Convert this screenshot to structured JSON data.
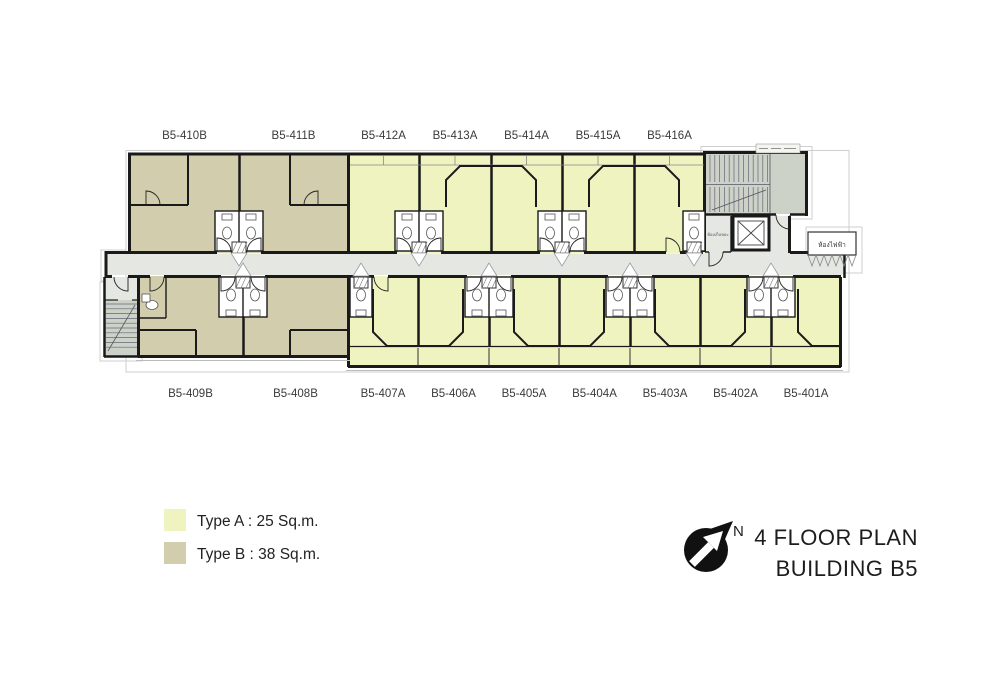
{
  "title": {
    "line1": "4 FLOOR PLAN",
    "line2": "BUILDING B5"
  },
  "north_label": "N",
  "legend": {
    "items": [
      {
        "name": "Type A",
        "text": "Type A :  25 Sq.m.",
        "color": "#eef3c0"
      },
      {
        "name": "Type B",
        "text": "Type B :  38 Sq.m.",
        "color": "#d1cdad"
      }
    ]
  },
  "colors": {
    "type_a": "#eef3c0",
    "type_b": "#d1cdad",
    "corridor": "#e4e7e2",
    "stair": "#ccd2c7",
    "wall": "#1a1a1a",
    "label_text": "#3a3a3a"
  },
  "units": {
    "top": [
      {
        "label": "B5-410B",
        "type": "B"
      },
      {
        "label": "B5-411B",
        "type": "B"
      },
      {
        "label": "B5-412A",
        "type": "A"
      },
      {
        "label": "B5-413A",
        "type": "A"
      },
      {
        "label": "B5-414A",
        "type": "A"
      },
      {
        "label": "B5-415A",
        "type": "A"
      },
      {
        "label": "B5-416A",
        "type": "A"
      }
    ],
    "bottom": [
      {
        "label": "B5-409B",
        "type": "B"
      },
      {
        "label": "B5-408B",
        "type": "B"
      },
      {
        "label": "B5-407A",
        "type": "A"
      },
      {
        "label": "B5-406A",
        "type": "A"
      },
      {
        "label": "B5-405A",
        "type": "A"
      },
      {
        "label": "B5-404A",
        "type": "A"
      },
      {
        "label": "B5-403A",
        "type": "A"
      },
      {
        "label": "B5-402A",
        "type": "A"
      },
      {
        "label": "B5-401A",
        "type": "A"
      }
    ]
  },
  "rooms": {
    "trash": "ห้องเก็บขยะ",
    "electrical": "ห้องไฟฟ้า"
  }
}
